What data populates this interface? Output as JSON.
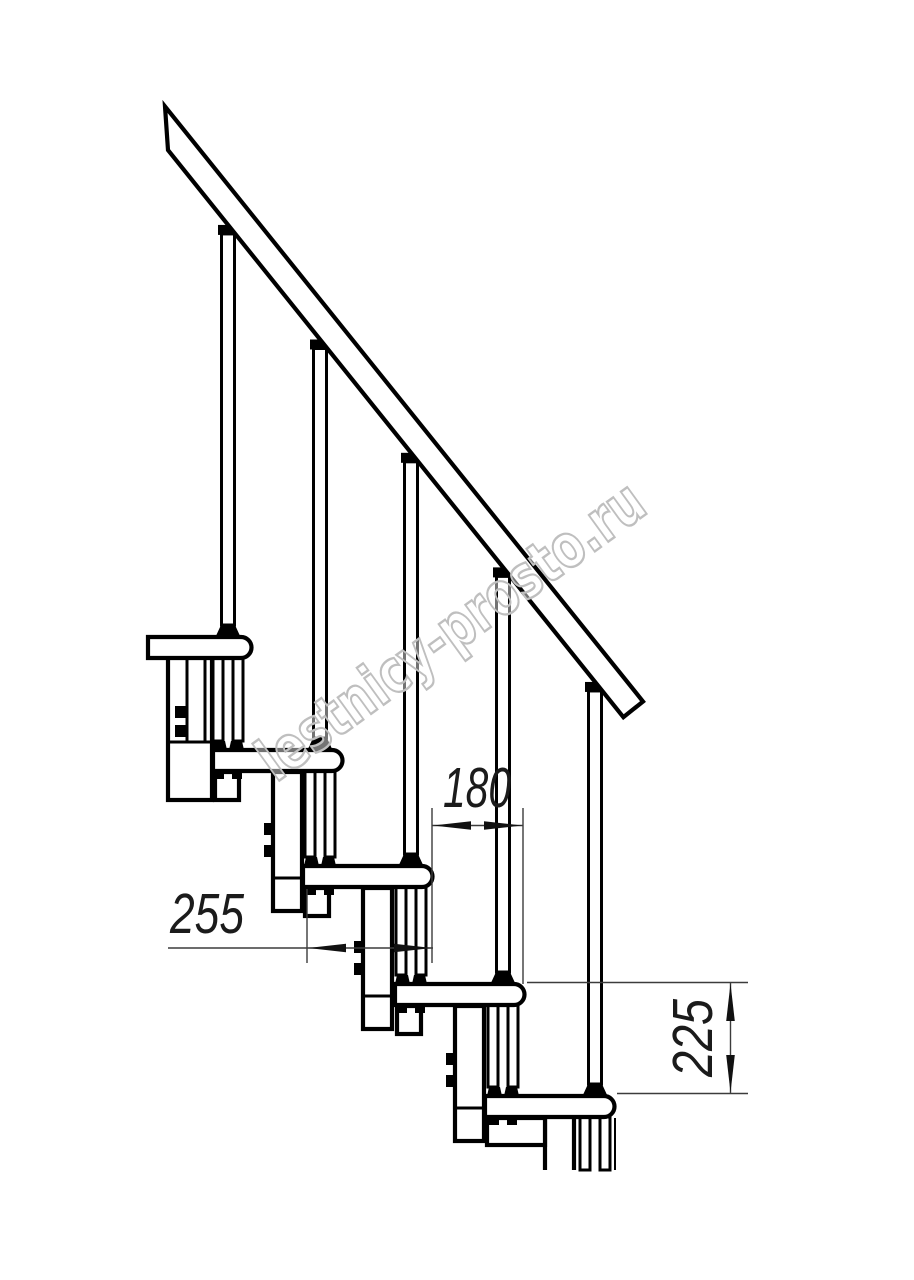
{
  "drawing": {
    "kind": "staircase-side-view-technical-drawing",
    "watermark": {
      "text": "lestnicy-prosto.ru",
      "color": "#bfbfbf"
    },
    "dims": {
      "tread_depth": {
        "label": "255"
      },
      "going": {
        "label": "180"
      },
      "rise": {
        "label": "225"
      }
    },
    "colors": {
      "line": "#000000",
      "dim_line": "#3c3c3c",
      "dim_text": "#1b1b1b",
      "background": "#ffffff"
    }
  }
}
